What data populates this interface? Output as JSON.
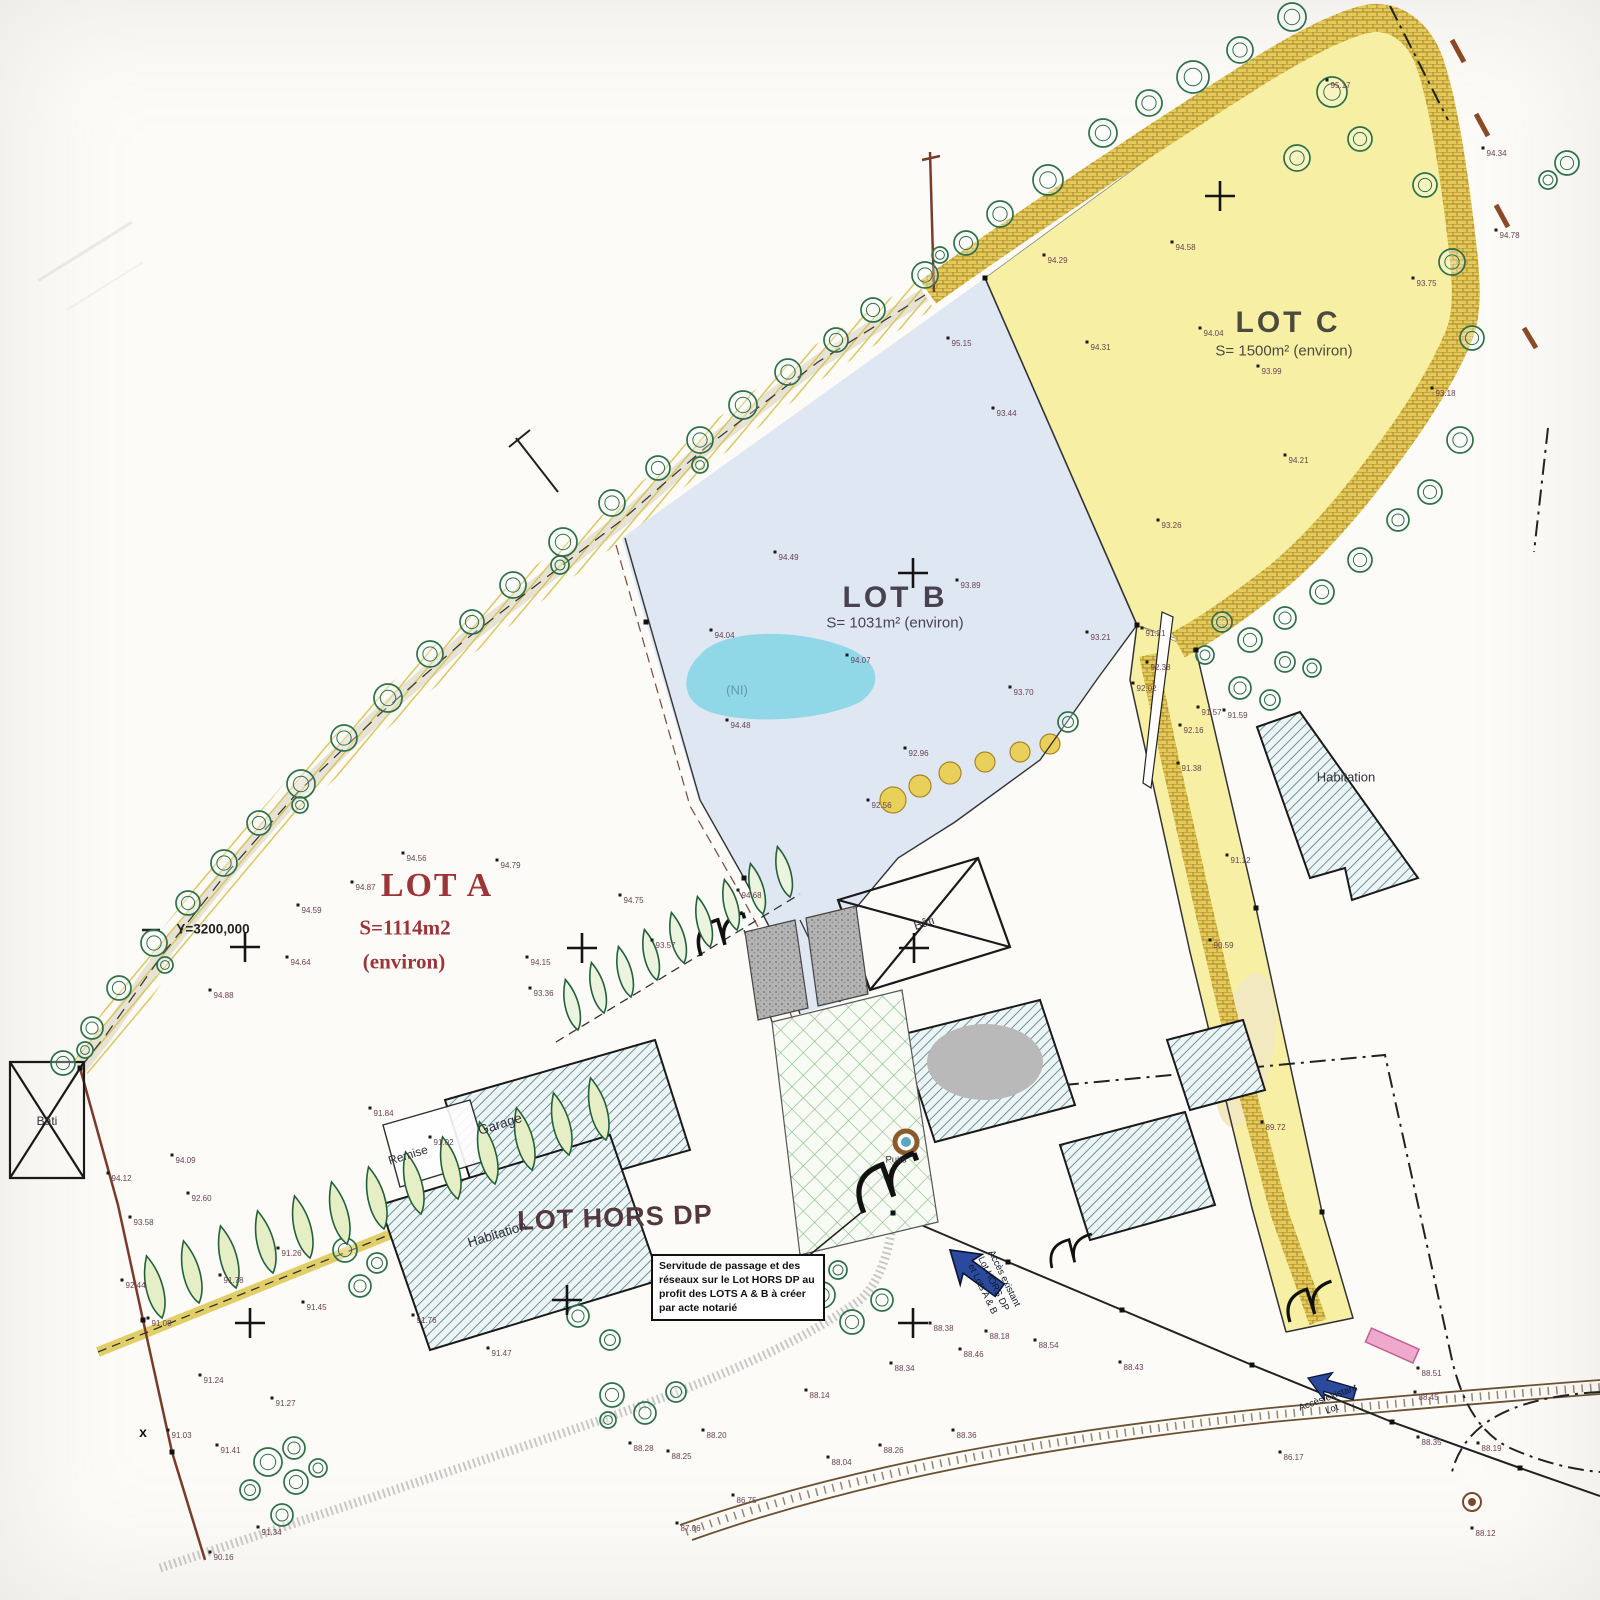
{
  "plan": {
    "lots": {
      "a": {
        "name": "LOT A",
        "area1": "S=1114m2",
        "area2": "(environ)"
      },
      "b": {
        "name": "LOT B",
        "area": "S= 1031m² (environ)"
      },
      "c": {
        "name": "LOT C",
        "area": "S= 1500m² (environ)"
      },
      "hors_dp": {
        "name": "LOT HORS DP"
      }
    },
    "labels": {
      "habitation_main": "Habitation",
      "habitation_east": "Habitation",
      "garage": "Garage",
      "remise": "Remise",
      "bati_west": "Bâti",
      "bati_center": "Bâti",
      "puits": "Puits",
      "ni": "(NI)",
      "x_mark": "x",
      "y_coordinate": "Y=3200,000"
    },
    "notes": {
      "servitude": "Servitude de passage et des réseaux sur le Lot HORS DP au profit des LOTS A & B à créer par acte notarié"
    },
    "access": {
      "center_line1": "Accès existant",
      "center_line2": "Lot HORS DP",
      "center_line3": "et Lots A & B",
      "east_line1": "Accès existant",
      "east_line2": "Lot"
    },
    "colors": {
      "lot_a_label": "#9c3538",
      "lot_b_fill": "#dfe7f3",
      "lot_c_fill": "#f7f0a4",
      "hedge_band": "#e4ca58",
      "building_hatch": "#5d8795",
      "access_arrow": "#2b4a9e",
      "gate_pink": "#f0a9cc",
      "water_blob": "#8bd7e6"
    },
    "map": {
      "spots": [
        [
          1327,
          80,
          "95.17"
        ],
        [
          1483,
          148,
          "94.34"
        ],
        [
          1496,
          230,
          "94.78"
        ],
        [
          1172,
          242,
          "94.58"
        ],
        [
          1200,
          328,
          "94.04"
        ],
        [
          1258,
          366,
          "93.99"
        ],
        [
          1413,
          278,
          "93.75"
        ],
        [
          1087,
          342,
          "94.31"
        ],
        [
          1285,
          455,
          "94.21"
        ],
        [
          1158,
          520,
          "93.26"
        ],
        [
          1044,
          255,
          "94.29"
        ],
        [
          1432,
          388,
          "93.18"
        ],
        [
          948,
          338,
          "95.15"
        ],
        [
          993,
          408,
          "93.44"
        ],
        [
          775,
          552,
          "94.49"
        ],
        [
          957,
          580,
          "93.89"
        ],
        [
          711,
          630,
          "94.04"
        ],
        [
          847,
          655,
          "94.07"
        ],
        [
          1010,
          687,
          "93.70"
        ],
        [
          727,
          720,
          "94.48"
        ],
        [
          1087,
          632,
          "93.21"
        ],
        [
          905,
          748,
          "92.96"
        ],
        [
          868,
          800,
          "92.56"
        ],
        [
          1147,
          662,
          "92.38"
        ],
        [
          1133,
          683,
          "92.02"
        ],
        [
          1142,
          628,
          "91.21"
        ],
        [
          1180,
          725,
          "92.16"
        ],
        [
          1198,
          707,
          "91.57"
        ],
        [
          1224,
          710,
          "91.59"
        ],
        [
          1178,
          763,
          "91.38"
        ],
        [
          1210,
          940,
          "90.59"
        ],
        [
          1262,
          1122,
          "89.72"
        ],
        [
          1227,
          855,
          "91.12"
        ],
        [
          403,
          853,
          "94.56"
        ],
        [
          497,
          860,
          "94.79"
        ],
        [
          620,
          895,
          "94.75"
        ],
        [
          738,
          890,
          "94.68"
        ],
        [
          527,
          957,
          "94.15"
        ],
        [
          530,
          988,
          "93.36"
        ],
        [
          352,
          882,
          "94.87"
        ],
        [
          298,
          905,
          "94.59"
        ],
        [
          287,
          957,
          "94.64"
        ],
        [
          210,
          990,
          "94.88"
        ],
        [
          652,
          940,
          "93.57"
        ],
        [
          370,
          1108,
          "91.84"
        ],
        [
          430,
          1137,
          "91.02"
        ],
        [
          172,
          1155,
          "94.09"
        ],
        [
          108,
          1173,
          "94.12"
        ],
        [
          188,
          1193,
          "92.60"
        ],
        [
          130,
          1217,
          "93.58"
        ],
        [
          122,
          1280,
          "92.44"
        ],
        [
          278,
          1248,
          "91.26"
        ],
        [
          220,
          1275,
          "91.78"
        ],
        [
          303,
          1302,
          "91.45"
        ],
        [
          148,
          1318,
          "91.08"
        ],
        [
          200,
          1375,
          "91.24"
        ],
        [
          272,
          1398,
          "91.27"
        ],
        [
          168,
          1430,
          "91.03"
        ],
        [
          217,
          1445,
          "91.41"
        ],
        [
          258,
          1527,
          "91.34"
        ],
        [
          210,
          1552,
          "90.16"
        ],
        [
          413,
          1315,
          "91.76"
        ],
        [
          488,
          1348,
          "91.47"
        ],
        [
          630,
          1443,
          "88.28"
        ],
        [
          668,
          1451,
          "88.25"
        ],
        [
          703,
          1430,
          "88.20"
        ],
        [
          806,
          1390,
          "88.14"
        ],
        [
          733,
          1495,
          "86.75"
        ],
        [
          677,
          1523,
          "87.06"
        ],
        [
          828,
          1457,
          "88.04"
        ],
        [
          880,
          1445,
          "88.26"
        ],
        [
          953,
          1430,
          "88.36"
        ],
        [
          930,
          1323,
          "88.38"
        ],
        [
          960,
          1349,
          "88.46"
        ],
        [
          891,
          1363,
          "88.34"
        ],
        [
          986,
          1331,
          "88.18"
        ],
        [
          1035,
          1340,
          "88.54"
        ],
        [
          1120,
          1362,
          "88.43"
        ],
        [
          1418,
          1368,
          "88.51"
        ],
        [
          1415,
          1392,
          "88.45"
        ],
        [
          1418,
          1437,
          "88.35"
        ],
        [
          1478,
          1443,
          "88.19"
        ],
        [
          1472,
          1528,
          "88.12"
        ],
        [
          1280,
          1452,
          "86.17"
        ]
      ],
      "crosses": [
        [
          1220,
          196
        ],
        [
          913,
          573
        ],
        [
          582,
          948
        ],
        [
          914,
          948
        ],
        [
          245,
          947
        ],
        [
          250,
          1323
        ],
        [
          567,
          1300
        ],
        [
          913,
          1323
        ]
      ],
      "squares": [
        [
          985,
          278
        ],
        [
          1137,
          625
        ],
        [
          1196,
          650
        ],
        [
          1256,
          908
        ],
        [
          1322,
          1212
        ],
        [
          893,
          1213
        ],
        [
          80,
          1068
        ],
        [
          143,
          1320
        ],
        [
          172,
          1452
        ],
        [
          646,
          622
        ],
        [
          744,
          878
        ],
        [
          1008,
          1262
        ],
        [
          1122,
          1310
        ],
        [
          1252,
          1365
        ],
        [
          1392,
          1422
        ],
        [
          1520,
          1468
        ]
      ],
      "trees": [
        [
          1193,
          77,
          16
        ],
        [
          1240,
          50,
          13
        ],
        [
          1292,
          17,
          14
        ],
        [
          1332,
          92,
          15
        ],
        [
          1360,
          139,
          12
        ],
        [
          1297,
          158,
          13
        ],
        [
          1149,
          103,
          13
        ],
        [
          1103,
          133,
          14
        ],
        [
          1048,
          180,
          15
        ],
        [
          1000,
          214,
          13
        ],
        [
          966,
          243,
          12
        ],
        [
          925,
          275,
          13
        ],
        [
          873,
          310,
          12
        ],
        [
          836,
          340,
          12
        ],
        [
          788,
          372,
          13
        ],
        [
          743,
          405,
          14
        ],
        [
          700,
          440,
          13
        ],
        [
          658,
          468,
          12
        ],
        [
          612,
          503,
          13
        ],
        [
          563,
          542,
          14
        ],
        [
          513,
          585,
          13
        ],
        [
          472,
          622,
          12
        ],
        [
          430,
          654,
          13
        ],
        [
          388,
          698,
          14
        ],
        [
          344,
          738,
          13
        ],
        [
          301,
          784,
          14
        ],
        [
          259,
          823,
          12
        ],
        [
          224,
          863,
          13
        ],
        [
          188,
          903,
          12
        ],
        [
          154,
          943,
          13
        ],
        [
          119,
          988,
          12
        ],
        [
          92,
          1028,
          11
        ],
        [
          63,
          1063,
          12
        ],
        [
          940,
          255,
          8
        ],
        [
          700,
          465,
          8
        ],
        [
          560,
          565,
          9
        ],
        [
          300,
          805,
          8
        ],
        [
          165,
          965,
          8
        ],
        [
          85,
          1050,
          8
        ],
        [
          1425,
          185,
          12
        ],
        [
          1452,
          262,
          13
        ],
        [
          1472,
          338,
          12
        ],
        [
          1460,
          440,
          13
        ],
        [
          1430,
          492,
          12
        ],
        [
          1398,
          520,
          11
        ],
        [
          1360,
          560,
          12
        ],
        [
          1322,
          592,
          12
        ],
        [
          1285,
          618,
          11
        ],
        [
          1250,
          640,
          12
        ],
        [
          1285,
          662,
          10
        ],
        [
          1312,
          668,
          9
        ],
        [
          1222,
          622,
          10
        ],
        [
          1205,
          655,
          9
        ],
        [
          1240,
          688,
          11
        ],
        [
          1270,
          700,
          10
        ],
        [
          1567,
          163,
          12
        ],
        [
          1548,
          180,
          9
        ],
        [
          1068,
          722,
          10
        ],
        [
          822,
          1295,
          13
        ],
        [
          852,
          1322,
          12
        ],
        [
          882,
          1300,
          11
        ],
        [
          838,
          1270,
          9
        ],
        [
          268,
          1462,
          14
        ],
        [
          296,
          1482,
          12
        ],
        [
          294,
          1448,
          11
        ],
        [
          250,
          1490,
          10
        ],
        [
          282,
          1515,
          11
        ],
        [
          318,
          1468,
          9
        ],
        [
          345,
          1250,
          12
        ],
        [
          377,
          1263,
          10
        ],
        [
          360,
          1286,
          11
        ],
        [
          612,
          1395,
          12
        ],
        [
          645,
          1413,
          11
        ],
        [
          676,
          1392,
          10
        ],
        [
          608,
          1420,
          8
        ],
        [
          578,
          1316,
          11
        ],
        [
          610,
          1340,
          10
        ]
      ],
      "cypress_row_upper": [
        [
          578,
          1030
        ],
        [
          604,
          1013
        ],
        [
          631,
          997
        ],
        [
          657,
          980
        ],
        [
          684,
          963
        ],
        [
          710,
          947
        ],
        [
          737,
          930
        ],
        [
          763,
          914
        ],
        [
          790,
          897
        ]
      ],
      "cypress_row_lower": [
        [
          162,
          1318
        ],
        [
          199,
          1303
        ],
        [
          236,
          1288
        ],
        [
          273,
          1273
        ],
        [
          310,
          1258
        ],
        [
          347,
          1244
        ],
        [
          384,
          1229
        ],
        [
          421,
          1214
        ],
        [
          458,
          1199
        ],
        [
          495,
          1184
        ],
        [
          532,
          1170
        ],
        [
          569,
          1155
        ],
        [
          606,
          1140
        ]
      ]
    }
  }
}
